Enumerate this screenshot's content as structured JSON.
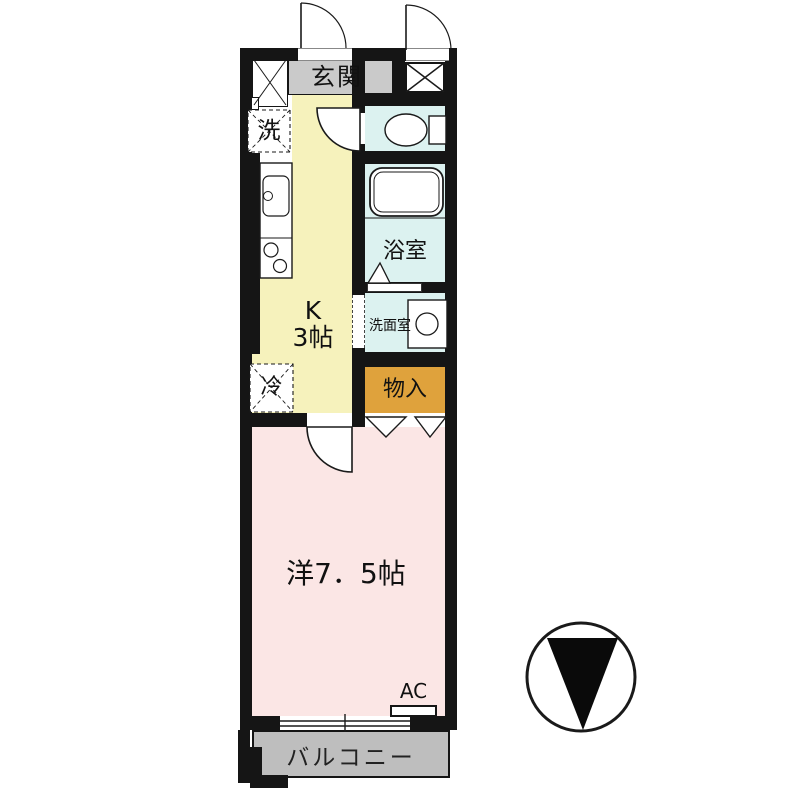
{
  "floorplan": {
    "title": "1K apartment floor plan",
    "labels": {
      "entrance": "玄関",
      "washer": "洗",
      "kitchen_name": "K",
      "kitchen_size": "3帖",
      "bathroom": "浴室",
      "washroom": "洗面室",
      "storage": "物入",
      "fridge": "冷",
      "main_room": "洋7．5帖",
      "ac": "AC",
      "balcony": "バルコニー"
    },
    "colors": {
      "wall": "#151515",
      "kitchen": "#F6F2BC",
      "wet_room": "#DCF2F0",
      "storage": "#DFA23C",
      "main_room": "#FBE6E5",
      "entrance_floor": "#CACACA",
      "balcony": "#BEBEBE",
      "line": "#1a1a1a",
      "fixture_fill": "#FFFFFF"
    },
    "icons": {
      "compass": "north-pointer-down"
    }
  }
}
